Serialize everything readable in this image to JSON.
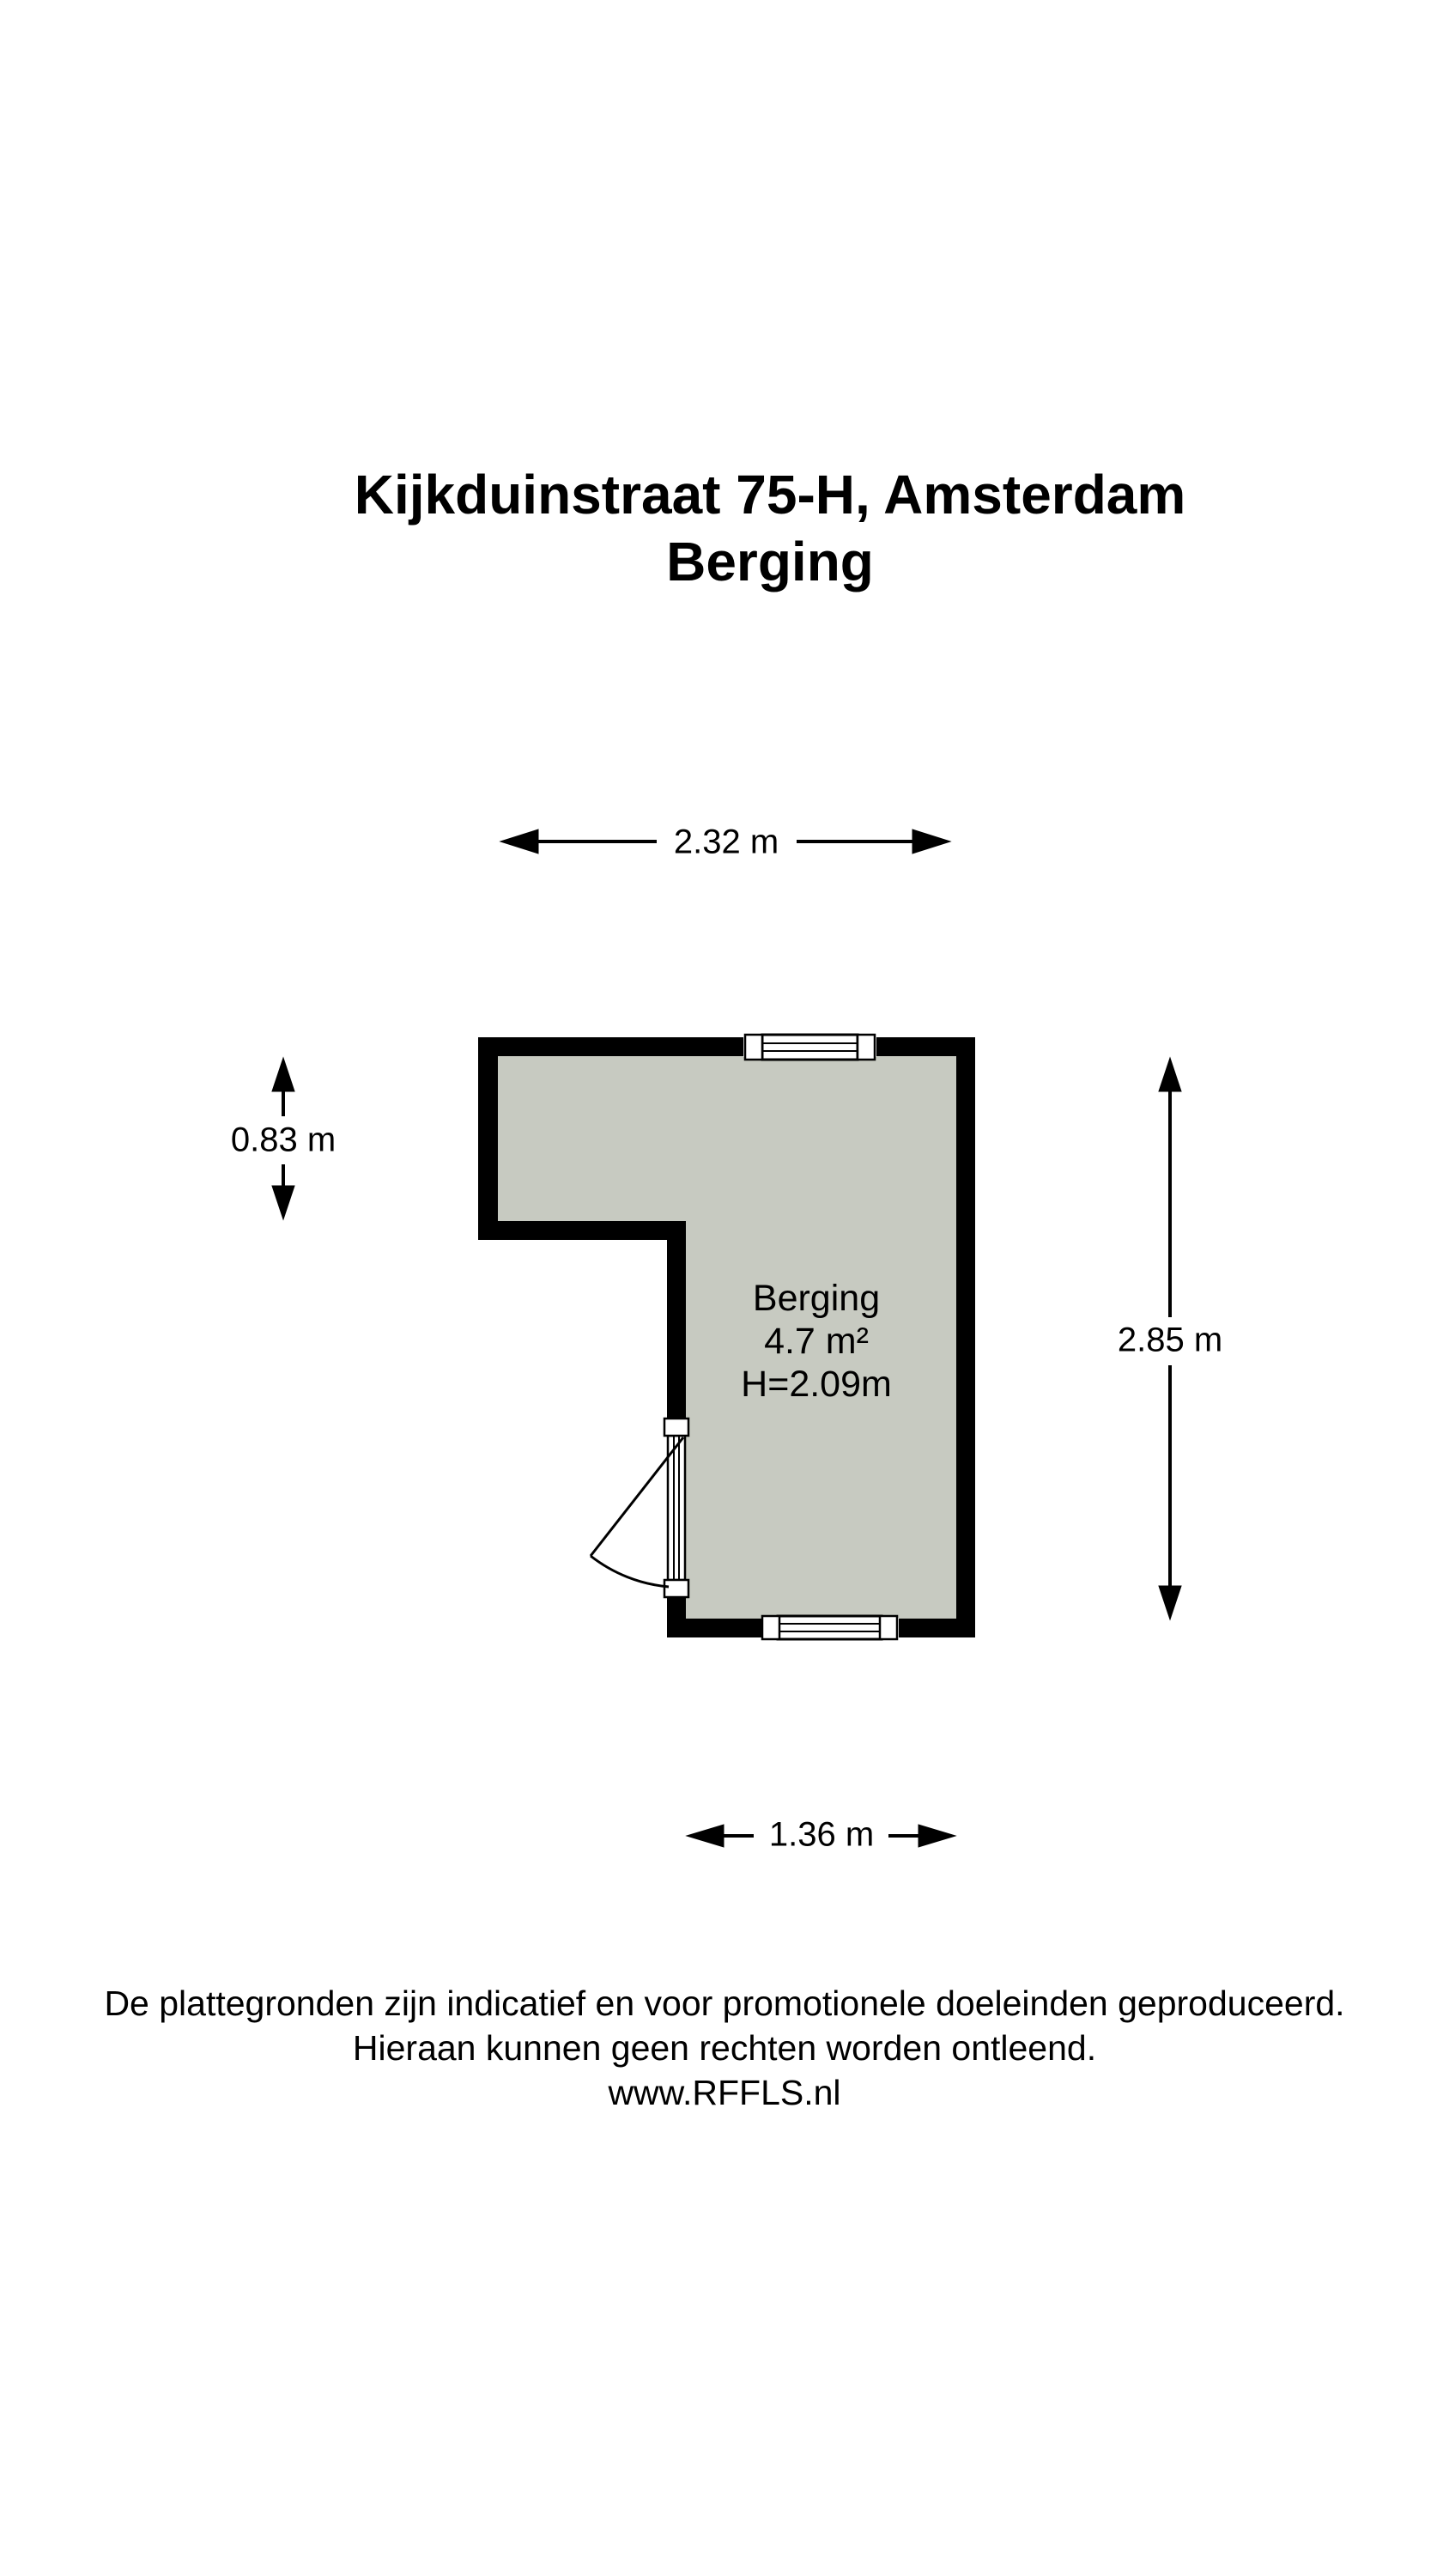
{
  "title": {
    "line1": "Kijkduinstraat 75-H, Amsterdam",
    "line2": "Berging"
  },
  "room_label": {
    "name": "Berging",
    "area": "4.7 m²",
    "ceiling_height": "H=2.09m"
  },
  "dimensions": {
    "width_top": "2.32 m",
    "height_left": "0.83 m",
    "height_right": "2.85 m",
    "width_bottom": "1.36 m"
  },
  "footer": {
    "disclaimer_line1": "De plattegronden zijn indicatief en voor promotionele doeleinden geproduceerd.",
    "disclaimer_line2": "Hieraan kunnen geen rechten worden ontleend.",
    "website": "www.RFFLS.nl"
  },
  "colors": {
    "background": "#ffffff",
    "wall": "#000000",
    "floor_fill": "#c7cac1",
    "text": "#000000"
  }
}
